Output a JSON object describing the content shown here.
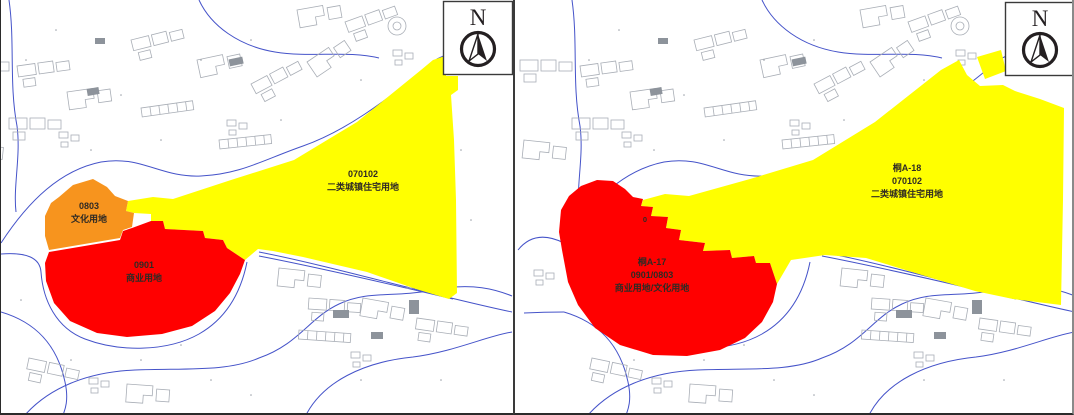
{
  "north": {
    "label": "N"
  },
  "colors": {
    "residential": "#FFFF00",
    "commercial": "#FF0000",
    "cultural": "#F7941E",
    "road": "#4553C9",
    "building": "#A9AEB6",
    "building_dark": "#8D939B",
    "compass": "#241F21",
    "speck": "#9AA0A8",
    "label": "#2F2A24"
  },
  "panels": [
    {
      "residential": {
        "code": "070102",
        "name": "二类城镇住宅用地"
      },
      "cultural": {
        "code": "0803",
        "name": "文化用地"
      },
      "commercial": {
        "code": "0901",
        "name": "商业用地"
      }
    },
    {
      "residential": {
        "plot": "桐A-18",
        "code": "070102",
        "name": "二类城镇住宅用地"
      },
      "commercial": {
        "plot": "桐A-17",
        "code": "0901/0803",
        "name": "商业用地/文化用地"
      },
      "stray": "0"
    }
  ]
}
